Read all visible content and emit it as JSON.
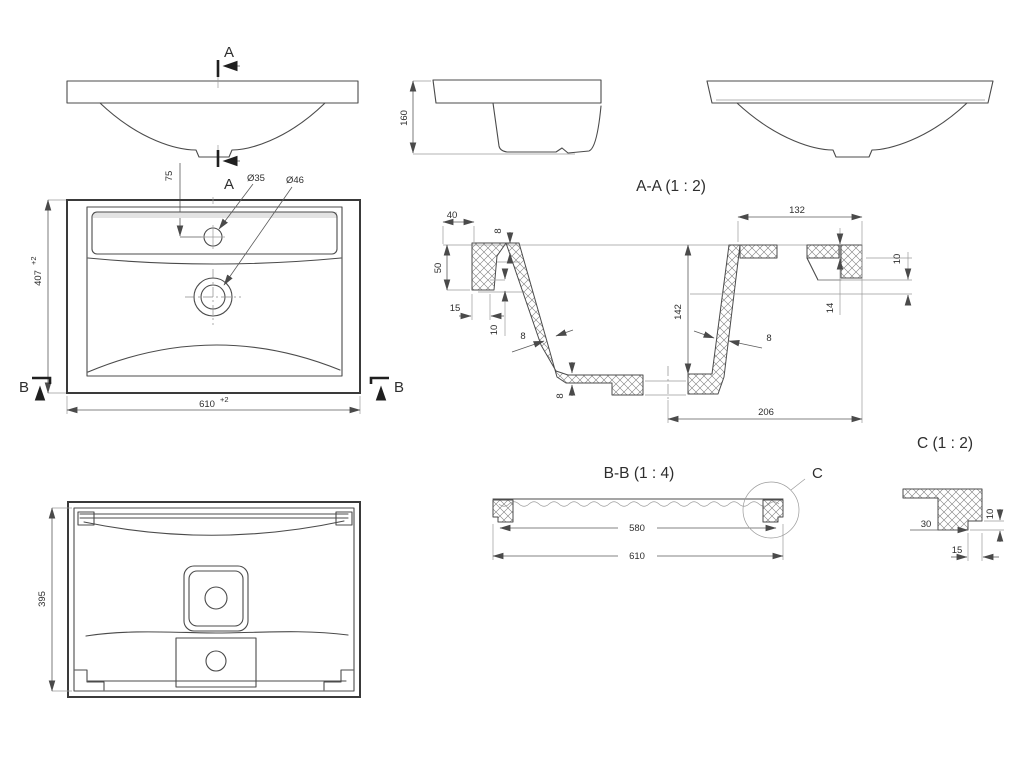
{
  "views": {
    "front": {
      "cut_label": "A"
    },
    "plan": {
      "cut_label": "B",
      "width": "610",
      "width_tol": "+2",
      "depth": "407",
      "depth_tol": "+2",
      "faucet_offset": "75",
      "faucet_hole_dia": "Ø35",
      "drain_hole_dia": "Ø46"
    },
    "bottom": {
      "depth": "395"
    },
    "side": {
      "height": "160"
    },
    "section_aa": {
      "title": "A-A (1 : 2)",
      "d40": "40",
      "d50": "50",
      "d15": "15",
      "d10_left": "10",
      "d8_top": "8",
      "d8_wall_left": "8",
      "d8_wall_right": "8",
      "d8_floor": "8",
      "d142": "142",
      "d132": "132",
      "d14": "14",
      "d10_right": "10",
      "d206": "206"
    },
    "section_bb": {
      "title": "B-B (1 : 4)",
      "d580": "580",
      "d610": "610",
      "detail_label": "C"
    },
    "detail_c": {
      "title": "C (1 : 2)",
      "d30": "30",
      "d15": "15",
      "d10": "10"
    }
  }
}
